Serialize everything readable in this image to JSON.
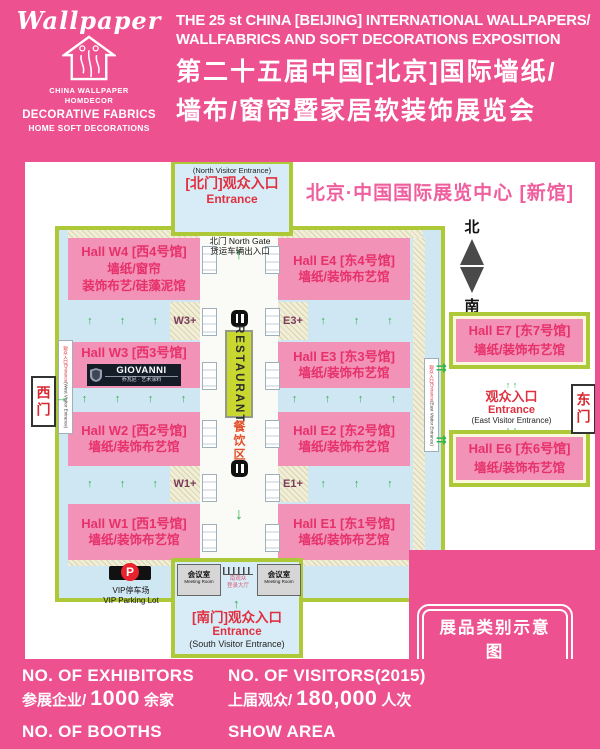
{
  "header": {
    "logo": {
      "brand": "Wallpaper",
      "org_line1": "CHINA WALLPAPER",
      "org_line2": "HOMDECOR",
      "fabrics": "DECORATIVE FABRICS",
      "soft": "HOME SOFT DECORATIONS"
    },
    "title_en1": "THE 25 st CHINA [BEIJING] INTERNATIONAL WALLPAPERS/",
    "title_en2": "WALLFABRICS AND SOFT DECORATIONS EXPOSITION",
    "title_cn1": "第二十五届中国[北京]国际墙纸/",
    "title_cn2": "墙布/窗帘暨家居软装饰展览会"
  },
  "map": {
    "venue_title": "北京·中国国际展览中心 [新馆]",
    "north_entrance": {
      "sub": "(North Visitor Entrance)",
      "cn": "[北门]观众入口",
      "en": "Entrance",
      "gate": "北门 North Gate",
      "gate_sub": "货运车辆出入口"
    },
    "compass": {
      "north": "北",
      "south": "南"
    },
    "halls": {
      "w4": {
        "name": "Hall W4 [西4号馆]",
        "desc1": "墙纸/窗帘",
        "desc2": "装饰布艺/硅藻泥馆"
      },
      "e4": {
        "name": "Hall E4 [东4号馆]",
        "desc": "墙纸/装饰布艺馆"
      },
      "w3": {
        "name": "Hall W3 [西3号馆]"
      },
      "e3": {
        "name": "Hall E3 [东3号馆]",
        "desc": "墙纸/装饰布艺馆"
      },
      "w2": {
        "name": "Hall W2 [西2号馆]",
        "desc": "墙纸/装饰布艺馆"
      },
      "e2": {
        "name": "Hall E2 [东2号馆]",
        "desc": "墙纸/装饰布艺馆"
      },
      "w1": {
        "name": "Hall W1 [西1号馆]",
        "desc": "墙纸/装饰布艺馆"
      },
      "e1": {
        "name": "Hall E1 [东1号馆]",
        "desc": "墙纸/装饰布艺馆"
      },
      "e7": {
        "name": "Hall E7 [东7号馆]",
        "desc": "墙纸/装饰布艺馆"
      },
      "e6": {
        "name": "Hall E6 [东6号馆]",
        "desc": "墙纸/装饰布艺馆"
      }
    },
    "giovanni": {
      "brand": "GIOVANNI",
      "sub": "乔瓦尼 · 艺术涂料"
    },
    "labels": {
      "w3plus": "W3+",
      "e3plus": "E3+",
      "w1plus": "W1+",
      "e1plus": "E1+",
      "restaurant": "RESTAURANT",
      "dining": "餐饮区"
    },
    "west_gate": {
      "gate": "西门",
      "strip_red": "观众入口Entrance",
      "strip_sub": "(West Visitor Entrance)"
    },
    "east_gate": {
      "gate": "东门",
      "cn": "观众入口",
      "en": "Entrance",
      "sub": "(East Visitor Entrance)",
      "strip_red": "观众入口Entrance",
      "strip_sub": "(East Visitor Entrance)"
    },
    "south": {
      "meeting_cn": "会议室",
      "meeting_en": "Meeting Room",
      "reg1": "南观众",
      "reg2": "登录大厅",
      "cn": "[南门]观众入口",
      "en": "Entrance",
      "sub": "(South Visitor Entrance)"
    },
    "vip": {
      "p": "P",
      "cn": "VIP停车场",
      "en": "VIP Parking Lot"
    },
    "exhibit_type": {
      "cn": "展品类别示意图",
      "en": "EXHIBIT  TYPE"
    }
  },
  "stats": {
    "exhibitors_label": "NO. OF EXHIBITORS",
    "exhibitors_cn": "参展企业/",
    "exhibitors_value": "1000",
    "exhibitors_unit": "余家",
    "booths_label": "NO. OF BOOTHS",
    "visitors_label": "NO. OF VISITORS(2015)",
    "visitors_cn": "上届观众/",
    "visitors_value": "180,000",
    "visitors_unit": "人次",
    "area_label": "SHOW AREA"
  },
  "icons": {
    "up_arrow": "↑",
    "down_arrow": "↓",
    "right_arrow": "→",
    "double_right_arrow": "⇉",
    "up_pair": "↑   ↑"
  },
  "colors": {
    "background_pink": "#ee5190",
    "hall_pink": "#f292b6",
    "hall_text_red": "#e6316b",
    "border_green": "#aec938",
    "walkway_blue": "#cfe6f3",
    "entrance_red": "#e03040",
    "restaurant_green": "#c8d830",
    "arrow_green": "#2eb44b",
    "venue_pink": "#ef5f9e"
  }
}
